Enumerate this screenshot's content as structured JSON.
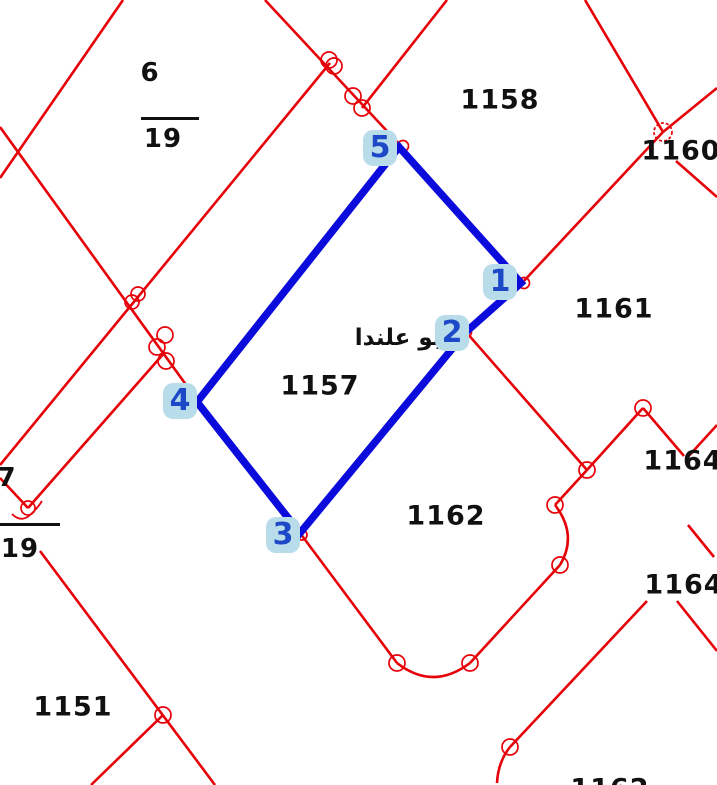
{
  "map": {
    "region_label": "ابو علندا",
    "parcels": {
      "p1158": "1158",
      "p1160": "1160",
      "p1161": "1161",
      "p1157": "1157",
      "p1162": "1162",
      "p1164a": "1164",
      "p1164b": "1164",
      "p1151": "1151",
      "p1162b": "1162"
    },
    "fractions": {
      "top_left": {
        "numerator": "6",
        "denominator": "19"
      },
      "left": {
        "numerator": "7",
        "denominator": "19"
      }
    },
    "selected_parcel": {
      "label": "1157",
      "vertices": {
        "v1": "1",
        "v2": "2",
        "v3": "3",
        "v4": "4",
        "v5": "5"
      }
    },
    "colors": {
      "boundary_red": "#e60008",
      "selection_blue": "#0b0bdc",
      "vertex_badge_bg": "#b9dcea",
      "vertex_badge_text": "#1d49c9",
      "label_text": "#111111"
    }
  }
}
